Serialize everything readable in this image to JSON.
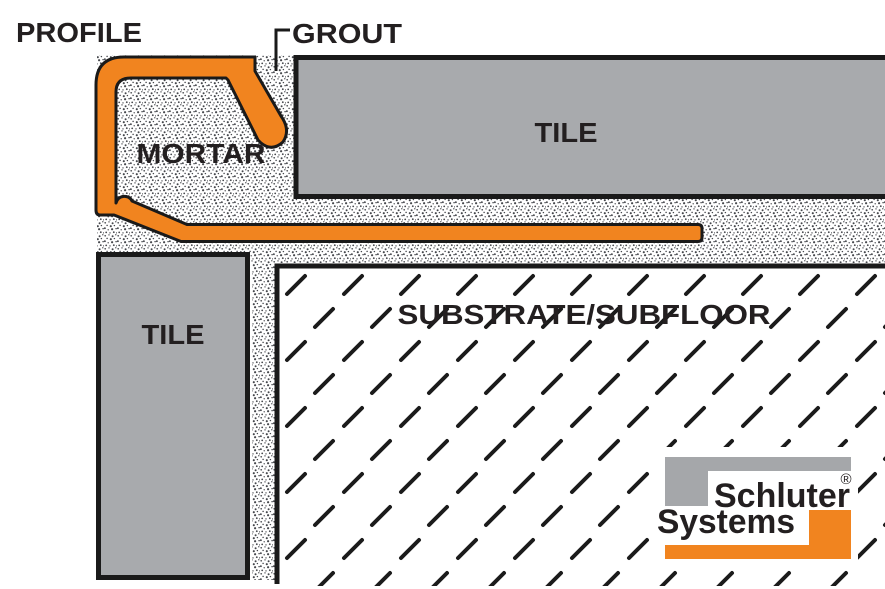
{
  "diagram": {
    "labels": {
      "profile": "PROFILE",
      "grout": "GROUT",
      "mortar": "MORTAR",
      "tile_top": "TILE",
      "tile_left": "TILE",
      "substrate": "SUBSTRATE/SUBFLOOR"
    },
    "logo": {
      "brand_line1": "Schluter",
      "registered_mark": "®",
      "brand_line2": "Systems"
    },
    "colors": {
      "profile_orange": "#F1841F",
      "tile_gray": "#A8AAAD",
      "logo_gray": "#A5A7AA",
      "logo_orange": "#F1841F",
      "outline_black": "#1A1A1A",
      "label_text": "#231F20"
    }
  }
}
